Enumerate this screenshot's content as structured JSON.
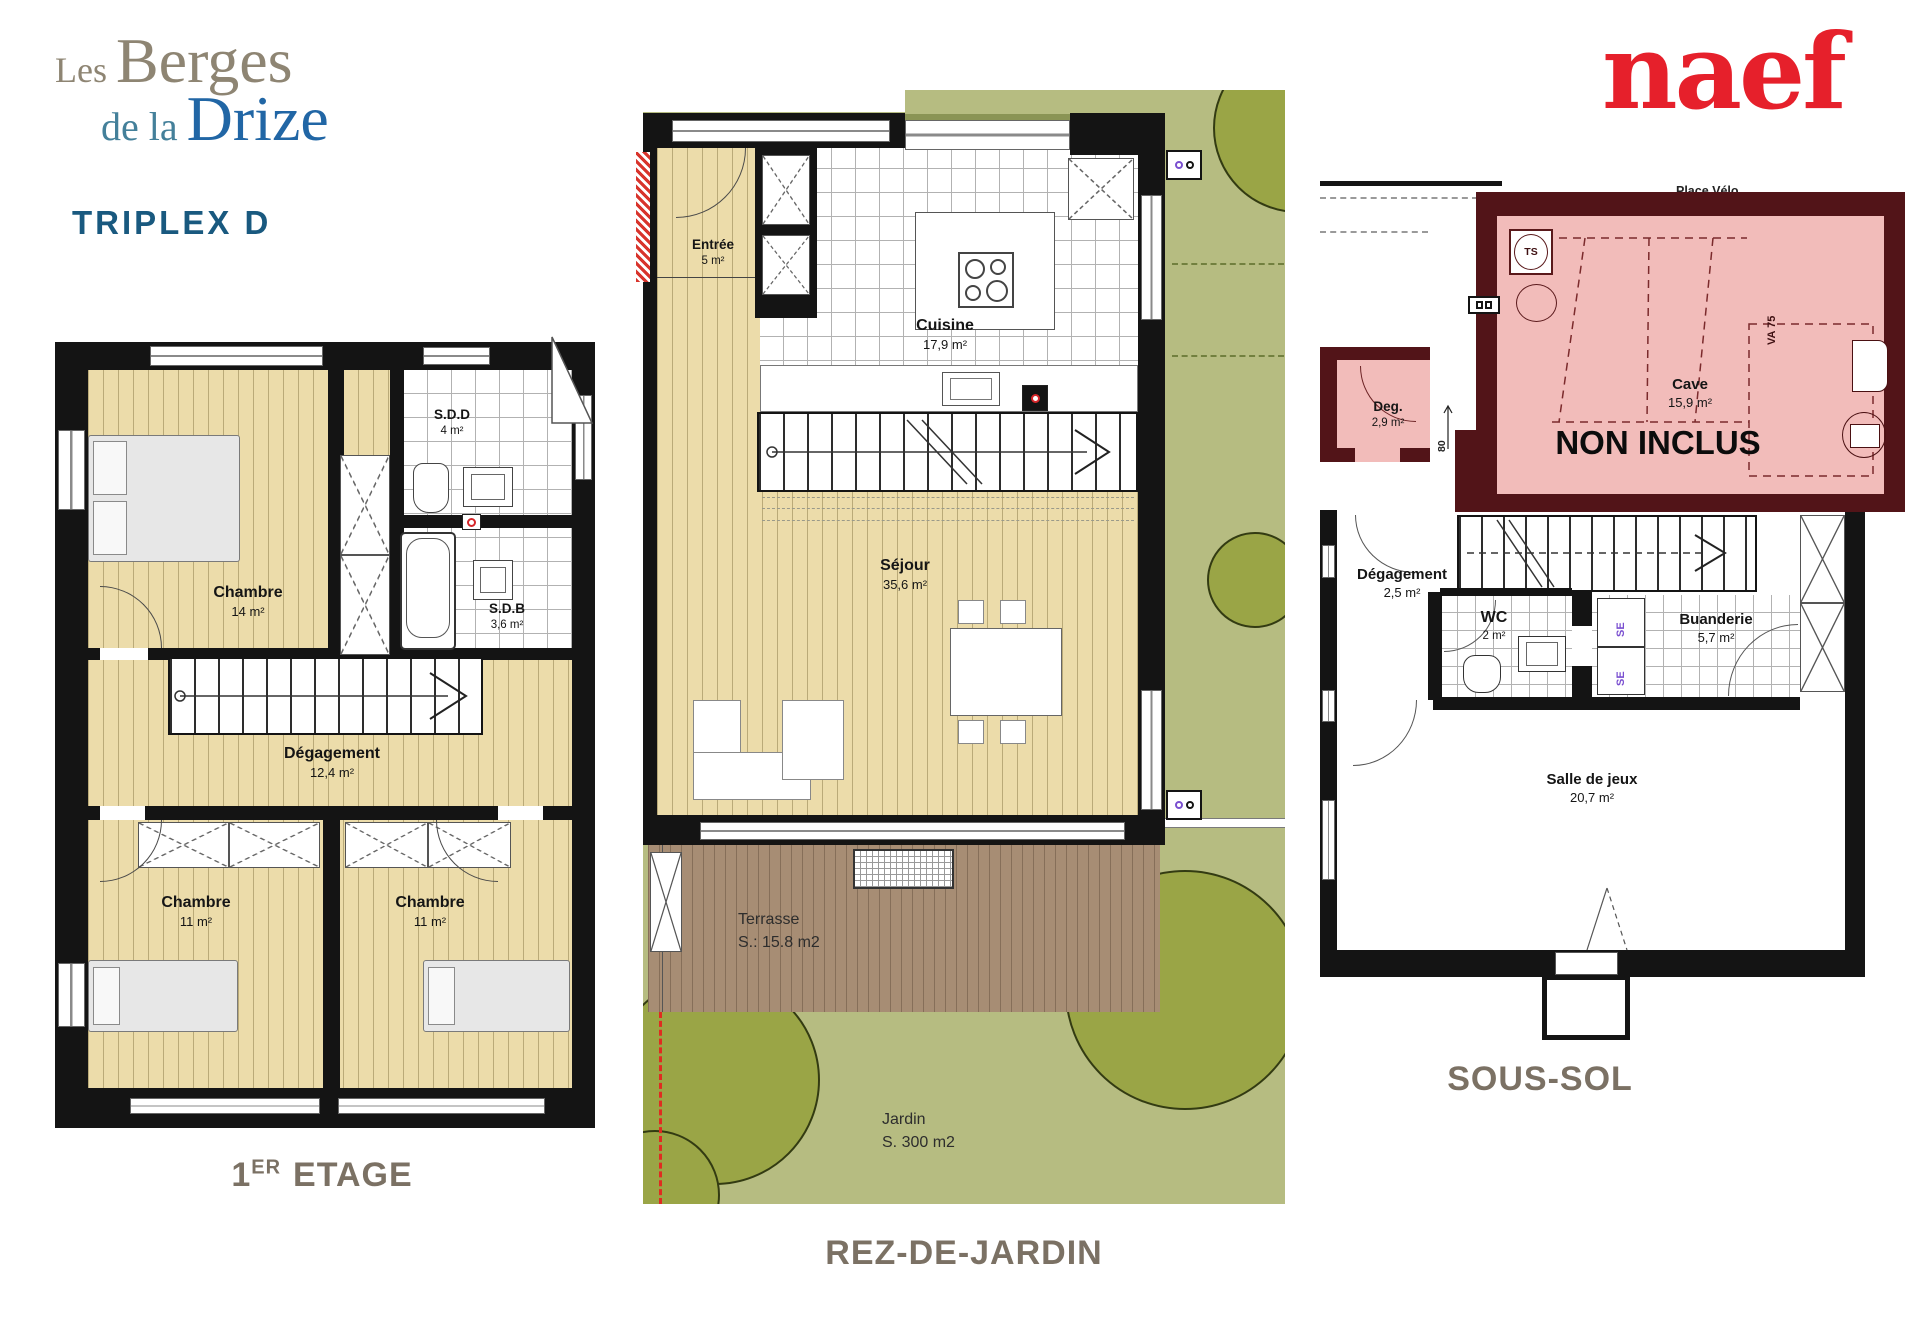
{
  "header": {
    "logo_les": "Les",
    "logo_berges": "Berges",
    "logo_de_la": "de la",
    "logo_drize": "Drize",
    "unit": "TRIPLEX D",
    "brand": "naef"
  },
  "captions": {
    "etage_num": "1",
    "etage_sup": "ER",
    "etage_rest": "ETAGE",
    "rdj": "REZ-DE-JARDIN",
    "soussol": "SOUS-SOL"
  },
  "p1": {
    "chambre1": {
      "name": "Chambre",
      "area": "14 m²"
    },
    "sdd": {
      "name": "S.D.D",
      "area": "4 m²"
    },
    "sdb": {
      "name": "S.D.B",
      "area": "3,6 m²"
    },
    "degagement": {
      "name": "Dégagement",
      "area": "12,4 m²"
    },
    "chambre2": {
      "name": "Chambre",
      "area": "11 m²"
    },
    "chambre3": {
      "name": "Chambre",
      "area": "11 m²"
    }
  },
  "p2": {
    "entree": {
      "name": "Entrée",
      "area": "5 m²"
    },
    "cuisine": {
      "name": "Cuisine",
      "area": "17,9 m²"
    },
    "sejour": {
      "name": "Séjour",
      "area": "35,6 m²"
    },
    "terrasse": {
      "name": "Terrasse",
      "area": "S.: 15.8 m2"
    },
    "jardin": {
      "name": "Jardin",
      "area": "S. 300 m2"
    }
  },
  "p3": {
    "place_velo": "Place Vélo",
    "cave": {
      "name": "Cave",
      "area": "15,9 m²"
    },
    "non_inclus": "NON INCLUS",
    "deg": {
      "name": "Deg.",
      "area": "2,9 m²"
    },
    "degagement": {
      "name": "Dégagement",
      "area": "2,5 m²"
    },
    "wc": {
      "name": "WC",
      "area": "2 m²"
    },
    "buanderie": {
      "name": "Buanderie",
      "area": "5,7 m²"
    },
    "salle_jeux": {
      "name": "Salle de jeux",
      "area": "20,7 m²"
    },
    "ts": "TS",
    "va75": "VA 75",
    "se1": "SE",
    "se2": "SE",
    "dim80": "80"
  },
  "colors": {
    "wall": "#141414",
    "wood": "#ecdcaa",
    "woodline": "rgba(110,95,45,0.40)",
    "tileline": "#b2b2b2",
    "garden": "#b6bc81",
    "tree": "#9aa546",
    "treeline": "#333b12",
    "terrace": "#a78d74",
    "pink": "#f2bcba",
    "darkred": "#521418",
    "red": "#d6262a",
    "purple": "#7a4fd0",
    "captioncol": "#7b7164",
    "logogray": "#8e8573",
    "logoteal": "#44809a",
    "logoblue": "#2166a5",
    "unitblue": "#19597f",
    "naefred": "#e6202b"
  }
}
